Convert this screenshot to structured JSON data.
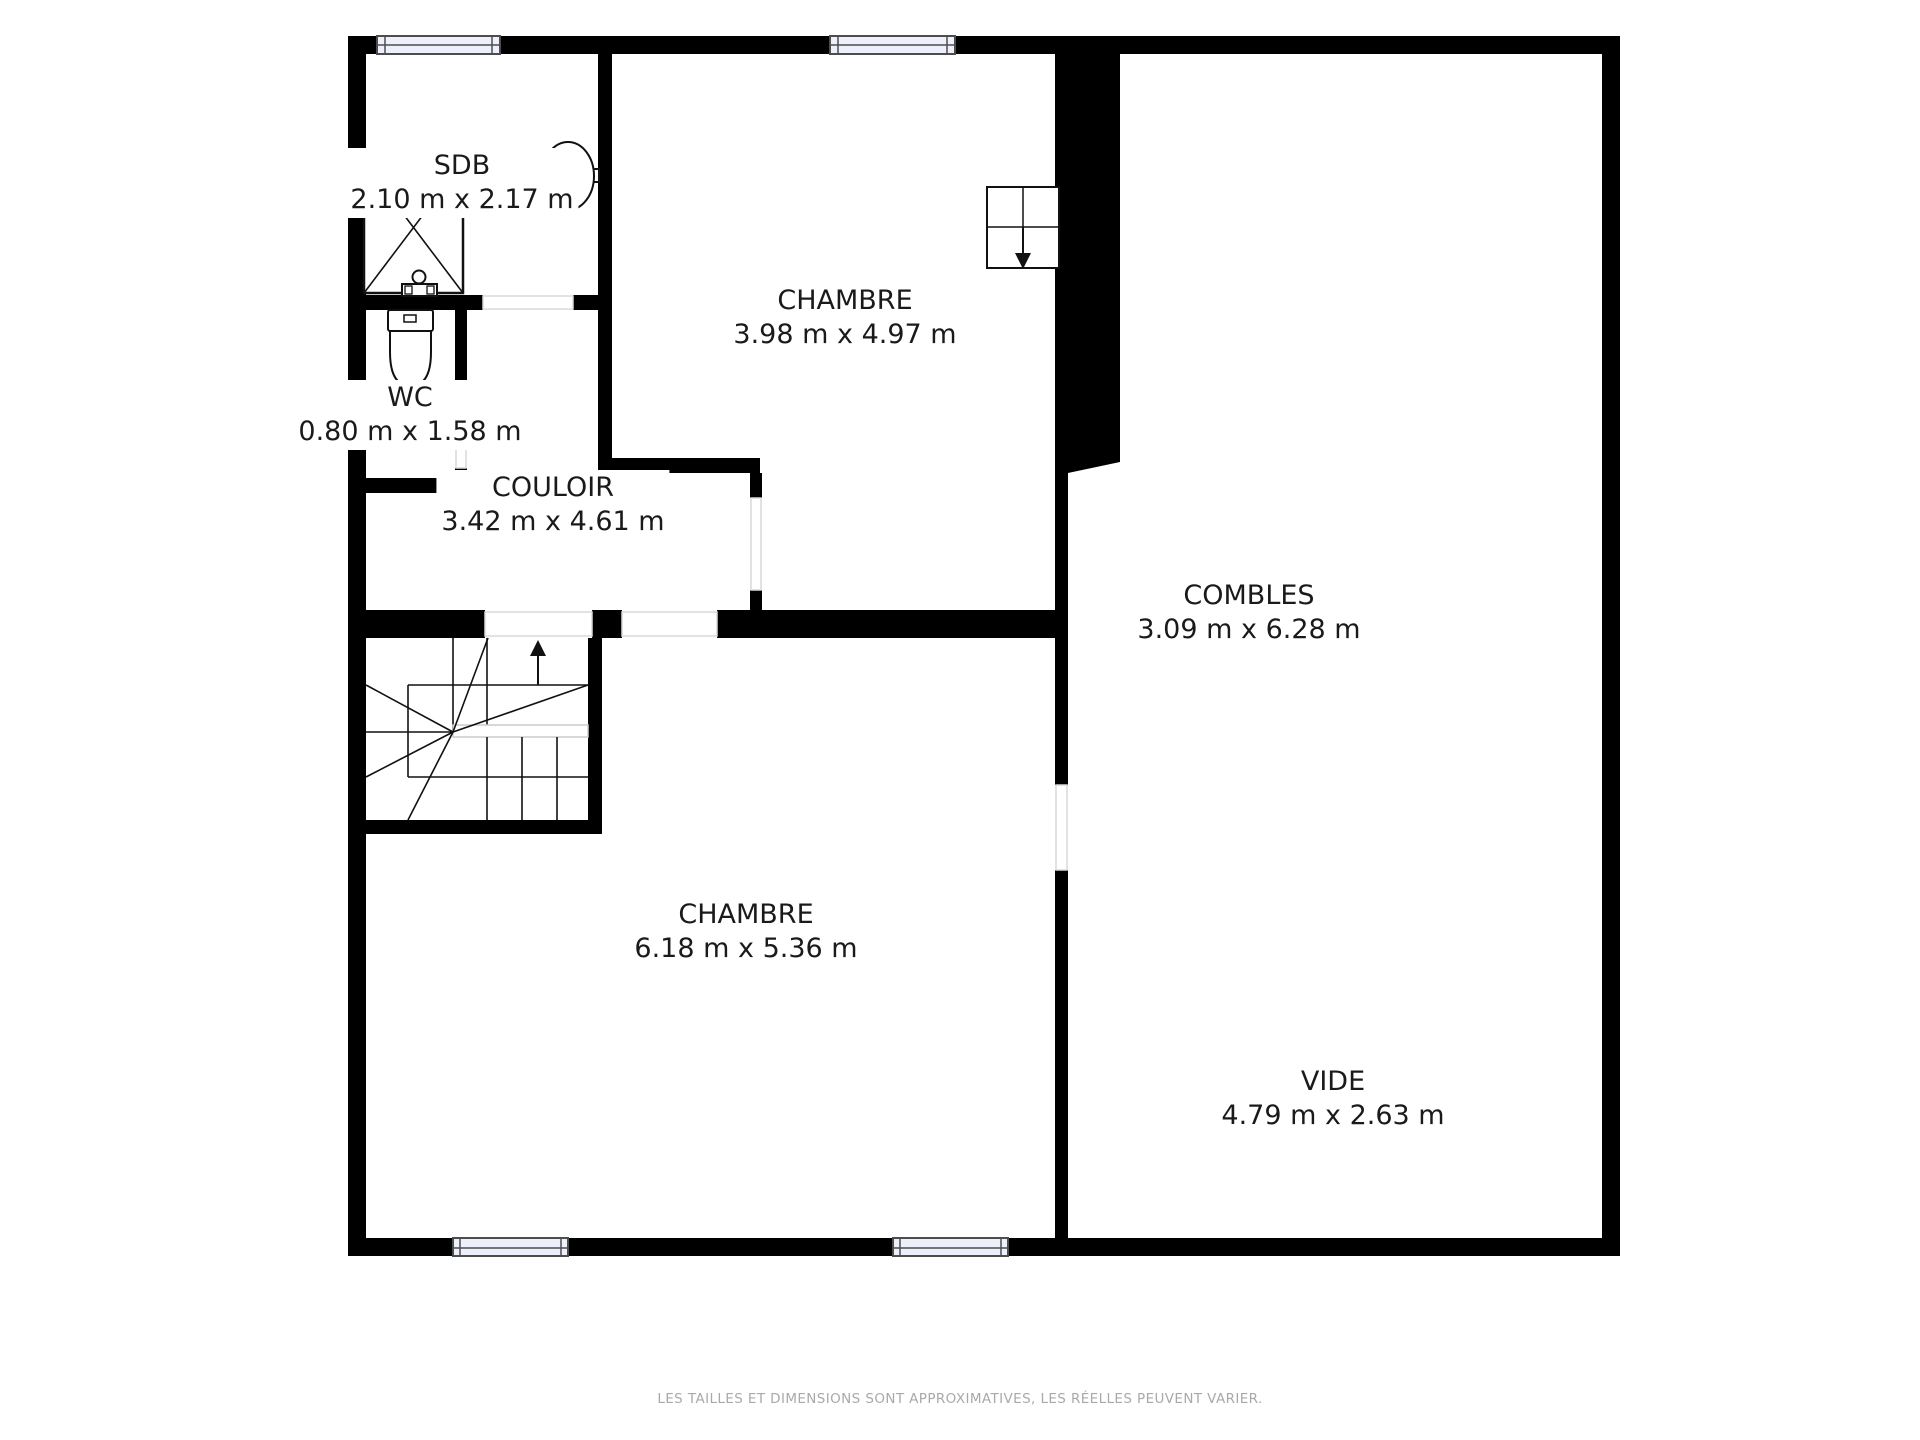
{
  "plan": {
    "rooms": {
      "sdb": {
        "name": "SDB",
        "dims": "2.10 m x 2.17 m"
      },
      "wc": {
        "name": "WC",
        "dims": "0.80 m x 1.58 m"
      },
      "couloir": {
        "name": "COULOIR",
        "dims": "3.42 m x 4.61 m"
      },
      "chambre_haut": {
        "name": "CHAMBRE",
        "dims": "3.98 m x 4.97 m"
      },
      "combles": {
        "name": "COMBLES",
        "dims": "3.09 m x 6.28 m"
      },
      "chambre_bas": {
        "name": "CHAMBRE",
        "dims": "6.18 m x 5.36 m"
      },
      "vide": {
        "name": "VIDE",
        "dims": "4.79 m x 2.63 m"
      }
    },
    "fixtures": [
      "shower-icon",
      "sink-icon",
      "washbasin-icon",
      "toilet-icon",
      "stairs-icon",
      "stairs-up-arrow-icon",
      "attic-hatch-icon",
      "hatch-down-arrow-icon",
      "window-icon"
    ],
    "footer": "LES TAILLES ET DIMENSIONS SONT APPROXIMATIVES, LES RÉELLES PEUVENT VARIER.",
    "colors": {
      "wall": "#000000",
      "floor": "#ffffff",
      "window_fill": "#edeffa",
      "window_frame": "#4d4d4d",
      "threshold": "#d9d9d9",
      "fixture_line": "#111111",
      "label_text": "#1a1a1a",
      "footer_text": "#a9a9a9"
    }
  }
}
